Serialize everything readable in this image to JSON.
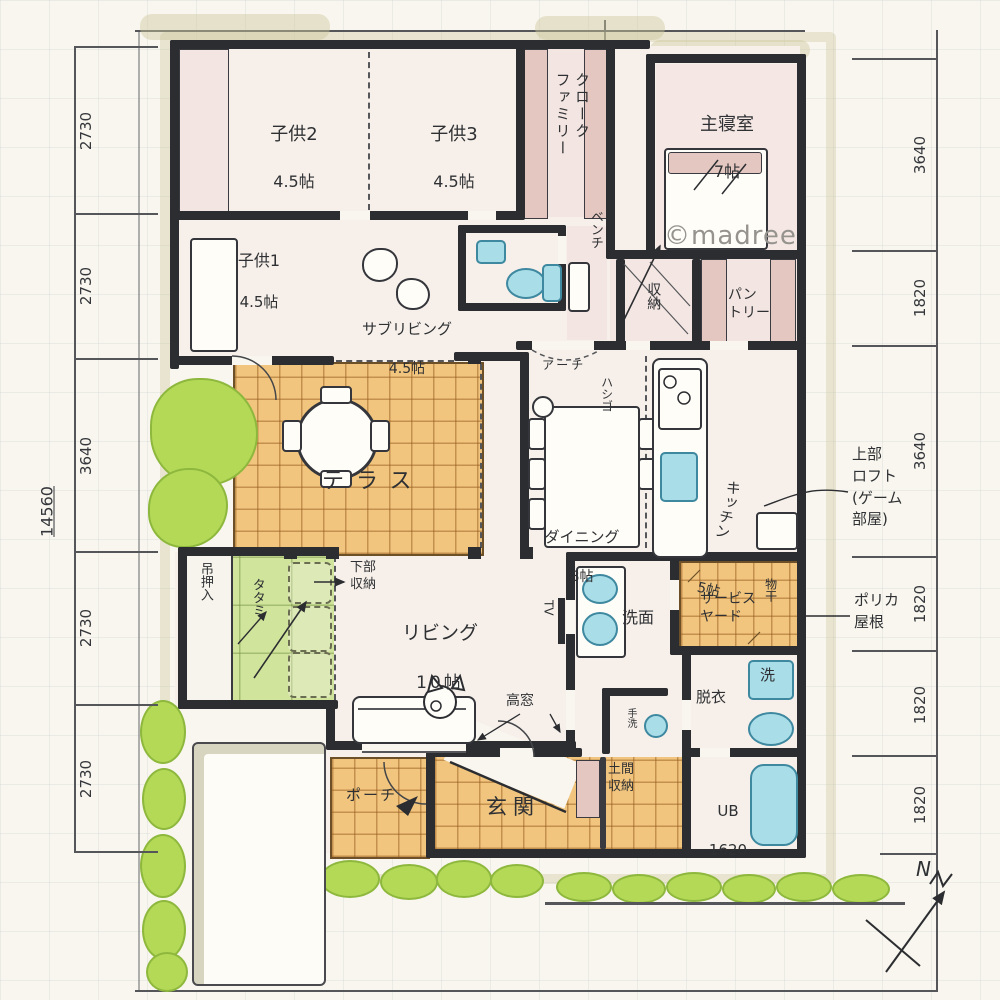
{
  "credit": "©madree",
  "compass": {
    "label": "N"
  },
  "dimensions": {
    "total_left": "14560",
    "left": [
      "2730",
      "2730",
      "3640",
      "2730",
      "2730"
    ],
    "right": [
      "3640",
      "1820",
      "3640",
      "1820",
      "1820",
      "1820"
    ]
  },
  "rooms": {
    "kodomo2": {
      "name": "子供2",
      "size": "4.5帖"
    },
    "kodomo3": {
      "name": "子供3",
      "size": "4.5帖"
    },
    "kodomo1": {
      "name": "子供1",
      "size": "4.5帖"
    },
    "family_closet": {
      "name": "ファミリークローク"
    },
    "bench": {
      "name": "ベンチ"
    },
    "master_bedroom": {
      "name": "主寝室",
      "size": "7帖"
    },
    "subliving": {
      "name": "サブリビング",
      "size": "4.5帖"
    },
    "storage": {
      "name": "収納"
    },
    "pantry": {
      "name": "パン\nトリー"
    },
    "kitchen": {
      "name": "キッチン",
      "size": "5帖"
    },
    "terrace": {
      "name": "テラス"
    },
    "dining": {
      "name": "ダイニング",
      "size": "8帖"
    },
    "living": {
      "name": "リビング",
      "size": "10帖"
    },
    "tatami_corner": {
      "name": "タタミ"
    },
    "hanging_closet": {
      "name": "吊押入"
    },
    "washroom": {
      "name": "洗面"
    },
    "service_yard": {
      "name": "サービス\nヤード"
    },
    "drying": {
      "name": "物干"
    },
    "dressing": {
      "name": "脱衣"
    },
    "washer": {
      "name": "洗"
    },
    "bath": {
      "name": "UB",
      "size": "1620"
    },
    "hand_wash": {
      "name": "手洗"
    },
    "doma_storage": {
      "name": "土間\n収納"
    },
    "entrance": {
      "name": "玄関"
    },
    "porch": {
      "name": "ポーチ"
    }
  },
  "notes": {
    "arch": "アーチ",
    "ladder": "ハシゴ",
    "tv": "TV",
    "high_window": "高窓",
    "lower_storage": "下部\n収納",
    "loft": "上部\nロフト\n(ゲーム\n部屋)",
    "poly_roof": "ポリカ\n屋根"
  },
  "colors": {
    "paper": "#f8f6ee",
    "ink": "#2c2d31",
    "pink": "#f3e5e1",
    "tile_orange": "#f1c57e",
    "tatami_green": "#d0e49c",
    "plant_green": "#b4d957",
    "fixture_blue": "#a9dde8",
    "khaki": "#d8d4b6"
  }
}
